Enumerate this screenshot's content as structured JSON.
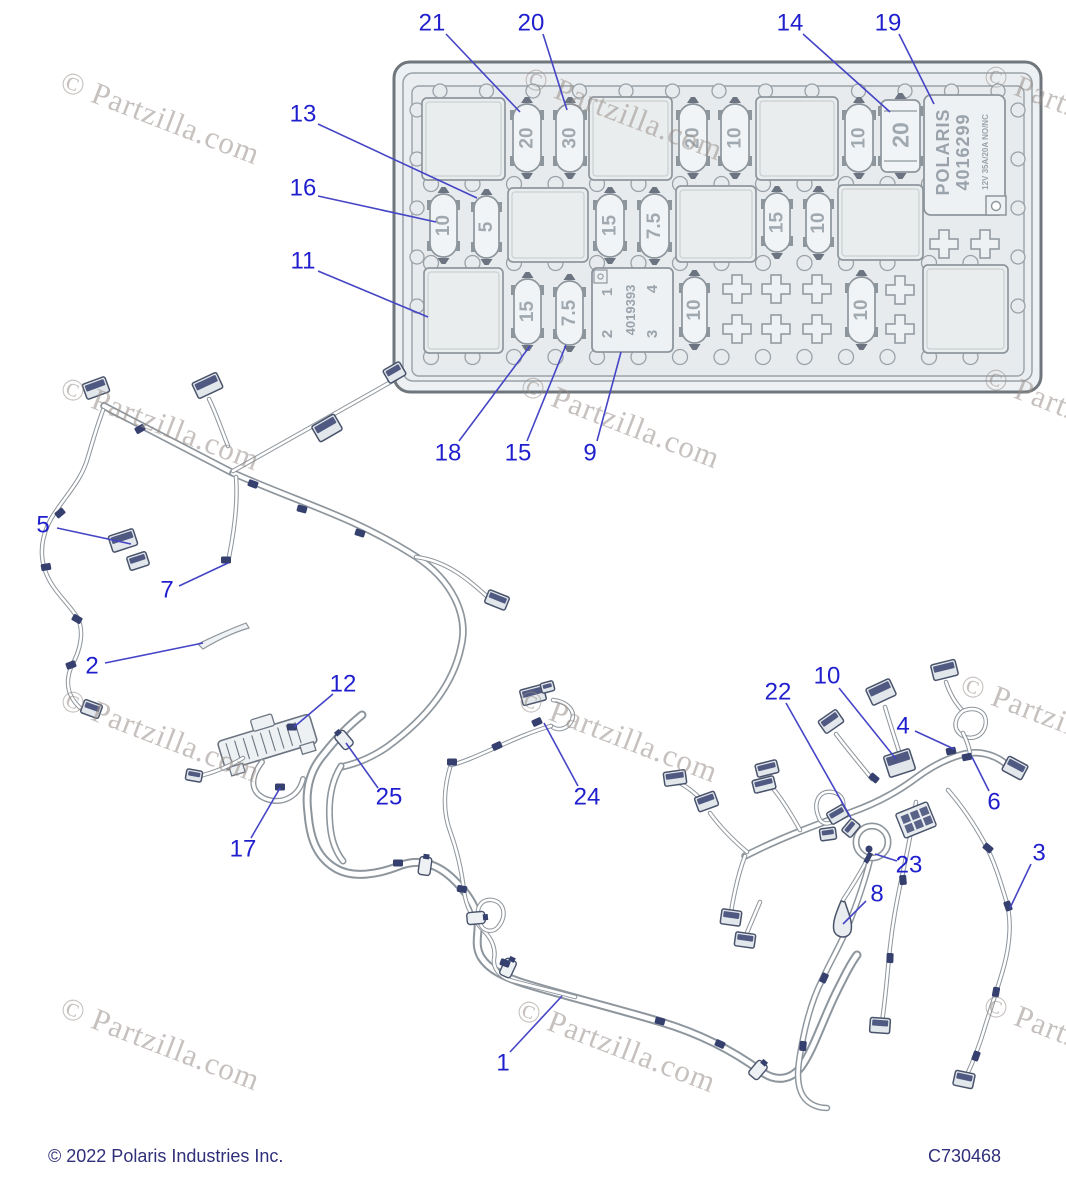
{
  "footer": {
    "copyright": "© 2022 Polaris Industries Inc.",
    "doc_code": "C730468"
  },
  "watermark": {
    "text": "© Partzilla.com",
    "positions": [
      {
        "x": 62,
        "y": 62
      },
      {
        "x": 525,
        "y": 58
      },
      {
        "x": 985,
        "y": 55
      },
      {
        "x": 62,
        "y": 368
      },
      {
        "x": 522,
        "y": 366
      },
      {
        "x": 985,
        "y": 358
      },
      {
        "x": 62,
        "y": 680
      },
      {
        "x": 520,
        "y": 680
      },
      {
        "x": 962,
        "y": 665
      },
      {
        "x": 62,
        "y": 988
      },
      {
        "x": 518,
        "y": 990
      },
      {
        "x": 985,
        "y": 985
      }
    ]
  },
  "colors": {
    "callout_text": "#1f1fce",
    "leader_line": "#4545c6",
    "outline_gray": "#8e969d",
    "fill_light": "#e9edee",
    "fill_lighter": "#f0f3f5",
    "navy": "#35406e",
    "fuse_digit": "#a0a9b0"
  },
  "fusebox": {
    "relay_large": {
      "line1": "POLARIS",
      "line2": "4016299",
      "line3": "12V  35A/20A  NO/NC"
    },
    "relay_small": {
      "number": "4019393",
      "pin_tl": "1",
      "pin_bl": "2",
      "pin_tr": "4",
      "pin_br": "3"
    },
    "fuses": [
      {
        "x": 513,
        "y": 104,
        "w": 28,
        "h": 68,
        "label": "20"
      },
      {
        "x": 556,
        "y": 104,
        "w": 28,
        "h": 68,
        "label": "30"
      },
      {
        "x": 679,
        "y": 104,
        "w": 28,
        "h": 68,
        "label": "20"
      },
      {
        "x": 721,
        "y": 104,
        "w": 28,
        "h": 68,
        "label": "10"
      },
      {
        "x": 845,
        "y": 104,
        "w": 28,
        "h": 68,
        "label": "10"
      },
      {
        "x": 430,
        "y": 194,
        "w": 27,
        "h": 63,
        "label": "10"
      },
      {
        "x": 474,
        "y": 196,
        "w": 25,
        "h": 62,
        "label": "5"
      },
      {
        "x": 596,
        "y": 194,
        "w": 28,
        "h": 63,
        "label": "15"
      },
      {
        "x": 640,
        "y": 194,
        "w": 29,
        "h": 64,
        "label": "7.5"
      },
      {
        "x": 764,
        "y": 193,
        "w": 26,
        "h": 59,
        "label": "15"
      },
      {
        "x": 806,
        "y": 193,
        "w": 25,
        "h": 60,
        "label": "10"
      },
      {
        "x": 514,
        "y": 279,
        "w": 27,
        "h": 65,
        "label": "15"
      },
      {
        "x": 556,
        "y": 281,
        "w": 27,
        "h": 64,
        "label": "7.5"
      },
      {
        "x": 682,
        "y": 277,
        "w": 25,
        "h": 66,
        "label": "10"
      },
      {
        "x": 848,
        "y": 277,
        "w": 27,
        "h": 66,
        "label": "10"
      }
    ],
    "maxi_fuse": {
      "x": 881,
      "y": 100,
      "w": 39,
      "h": 72,
      "label": "20"
    },
    "relay_slots": [
      {
        "x": 422,
        "y": 98,
        "w": 83,
        "h": 82
      },
      {
        "x": 589,
        "y": 97,
        "w": 83,
        "h": 83
      },
      {
        "x": 756,
        "y": 97,
        "w": 82,
        "h": 83
      },
      {
        "x": 508,
        "y": 188,
        "w": 80,
        "h": 74
      },
      {
        "x": 676,
        "y": 186,
        "w": 80,
        "h": 76
      },
      {
        "x": 838,
        "y": 185,
        "w": 85,
        "h": 75
      },
      {
        "x": 424,
        "y": 268,
        "w": 79,
        "h": 85
      },
      {
        "x": 923,
        "y": 265,
        "w": 85,
        "h": 88
      }
    ],
    "crosses": [
      {
        "x": 944,
        "y": 244
      },
      {
        "x": 985,
        "y": 244
      },
      {
        "x": 737,
        "y": 289
      },
      {
        "x": 776,
        "y": 289
      },
      {
        "x": 817,
        "y": 289
      },
      {
        "x": 900,
        "y": 290
      },
      {
        "x": 737,
        "y": 329
      },
      {
        "x": 776,
        "y": 329
      },
      {
        "x": 817,
        "y": 329
      },
      {
        "x": 900,
        "y": 329
      }
    ]
  },
  "callouts": [
    {
      "n": "21",
      "lx": 432,
      "ly": 23,
      "x1": 446,
      "y1": 34,
      "x2": 520,
      "y2": 112
    },
    {
      "n": "20",
      "lx": 531,
      "ly": 23,
      "x1": 543,
      "y1": 34,
      "x2": 567,
      "y2": 110
    },
    {
      "n": "14",
      "lx": 790,
      "ly": 23,
      "x1": 803,
      "y1": 34,
      "x2": 890,
      "y2": 112
    },
    {
      "n": "19",
      "lx": 888,
      "ly": 23,
      "x1": 899,
      "y1": 34,
      "x2": 934,
      "y2": 104
    },
    {
      "n": "13",
      "lx": 303,
      "ly": 114,
      "x1": 318,
      "y1": 124,
      "x2": 477,
      "y2": 198
    },
    {
      "n": "16",
      "lx": 303,
      "ly": 188,
      "x1": 318,
      "y1": 196,
      "x2": 436,
      "y2": 222
    },
    {
      "n": "11",
      "lx": 303,
      "ly": 261,
      "x1": 318,
      "y1": 271,
      "x2": 428,
      "y2": 317
    },
    {
      "n": "18",
      "lx": 448,
      "ly": 453,
      "x1": 459,
      "y1": 441,
      "x2": 530,
      "y2": 346
    },
    {
      "n": "15",
      "lx": 518,
      "ly": 453,
      "x1": 527,
      "y1": 441,
      "x2": 566,
      "y2": 345
    },
    {
      "n": "9",
      "lx": 590,
      "ly": 453,
      "x1": 597,
      "y1": 441,
      "x2": 621,
      "y2": 352
    },
    {
      "n": "5",
      "lx": 43,
      "ly": 525,
      "x1": 57,
      "y1": 528,
      "x2": 131,
      "y2": 544
    },
    {
      "n": "7",
      "lx": 167,
      "ly": 590,
      "x1": 179,
      "y1": 586,
      "x2": 228,
      "y2": 563
    },
    {
      "n": "2",
      "lx": 92,
      "ly": 666,
      "x1": 105,
      "y1": 663,
      "x2": 203,
      "y2": 643
    },
    {
      "n": "12",
      "lx": 343,
      "ly": 684,
      "x1": 333,
      "y1": 694,
      "x2": 294,
      "y2": 727
    },
    {
      "n": "25",
      "lx": 389,
      "ly": 797,
      "x1": 378,
      "y1": 788,
      "x2": 346,
      "y2": 743
    },
    {
      "n": "17",
      "lx": 243,
      "ly": 849,
      "x1": 251,
      "y1": 838,
      "x2": 280,
      "y2": 788
    },
    {
      "n": "24",
      "lx": 587,
      "ly": 797,
      "x1": 578,
      "y1": 786,
      "x2": 544,
      "y2": 723
    },
    {
      "n": "22",
      "lx": 778,
      "ly": 692,
      "x1": 786,
      "y1": 703,
      "x2": 851,
      "y2": 818
    },
    {
      "n": "10",
      "lx": 827,
      "ly": 676,
      "x1": 839,
      "y1": 688,
      "x2": 896,
      "y2": 759
    },
    {
      "n": "4",
      "lx": 903,
      "ly": 726,
      "x1": 915,
      "y1": 731,
      "x2": 954,
      "y2": 749
    },
    {
      "n": "6",
      "lx": 994,
      "ly": 802,
      "x1": 989,
      "y1": 791,
      "x2": 972,
      "y2": 757
    },
    {
      "n": "23",
      "lx": 909,
      "ly": 865,
      "x1": 897,
      "y1": 861,
      "x2": 875,
      "y2": 854
    },
    {
      "n": "8",
      "lx": 877,
      "ly": 894,
      "x1": 866,
      "y1": 901,
      "x2": 843,
      "y2": 924
    },
    {
      "n": "3",
      "lx": 1039,
      "ly": 853,
      "x1": 1031,
      "y1": 864,
      "x2": 1010,
      "y2": 908
    },
    {
      "n": "1",
      "lx": 503,
      "ly": 1063,
      "x1": 510,
      "y1": 1052,
      "x2": 562,
      "y2": 996
    }
  ]
}
